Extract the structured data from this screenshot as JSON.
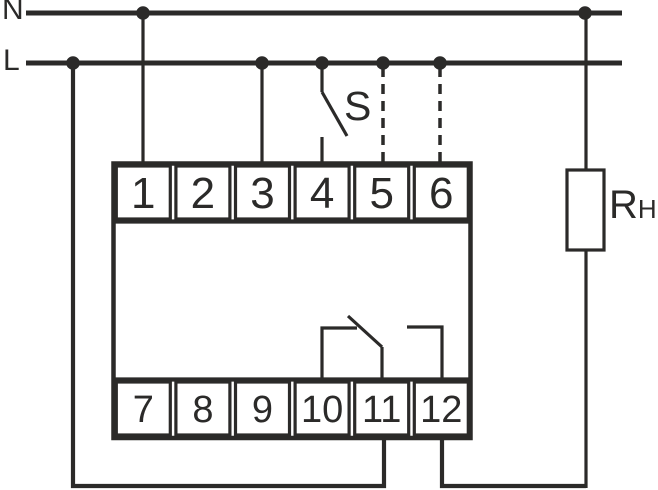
{
  "colors": {
    "ink": "#2b2a29",
    "bg": "#ffffff"
  },
  "labels": {
    "neutral": "N",
    "live": "L",
    "switch": "S",
    "load_main": "R",
    "load_sub": "H"
  },
  "terminals": {
    "top": [
      "1",
      "2",
      "3",
      "4",
      "5",
      "6"
    ],
    "bottom": [
      "7",
      "8",
      "9",
      "10",
      "11",
      "12"
    ]
  }
}
